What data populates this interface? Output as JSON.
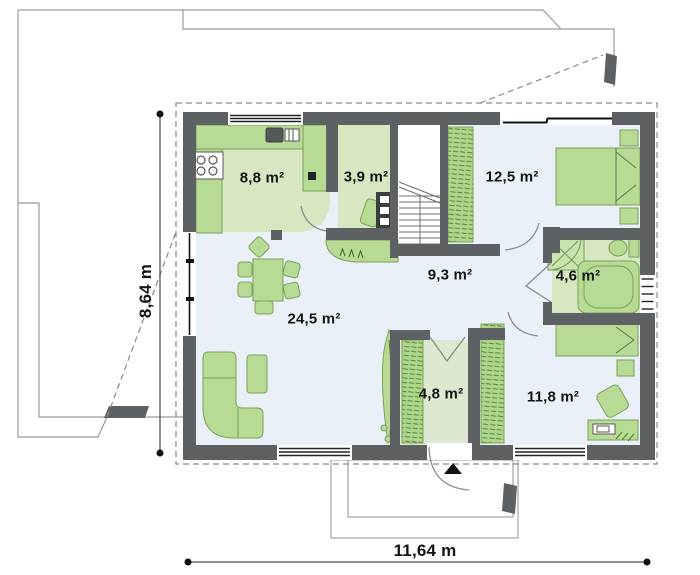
{
  "floorplan": {
    "type": "house-ground-floor-plan",
    "rooms": [
      {
        "name": "kitchen",
        "area": "8,8 m²"
      },
      {
        "name": "utility",
        "area": "3,9 m²"
      },
      {
        "name": "bedroom-top",
        "area": "12,5 m²"
      },
      {
        "name": "hall",
        "area": "9,3 m²"
      },
      {
        "name": "bathroom",
        "area": "4,6 m²"
      },
      {
        "name": "living-room",
        "area": "24,5 m²"
      },
      {
        "name": "vestibule",
        "area": "4,8 m²"
      },
      {
        "name": "bedroom-bottom",
        "area": "11,8 m²"
      }
    ],
    "dimensions": {
      "width": "11,64 m",
      "height": "8,64 m"
    },
    "colors": {
      "wall": "#5e6164",
      "furniture": "#b7db94",
      "furniture_border": "#7aa25a",
      "floor_green": "#d6e7c1",
      "floor_light": "#eaf0f7",
      "outline": "#9a9a9a"
    }
  }
}
